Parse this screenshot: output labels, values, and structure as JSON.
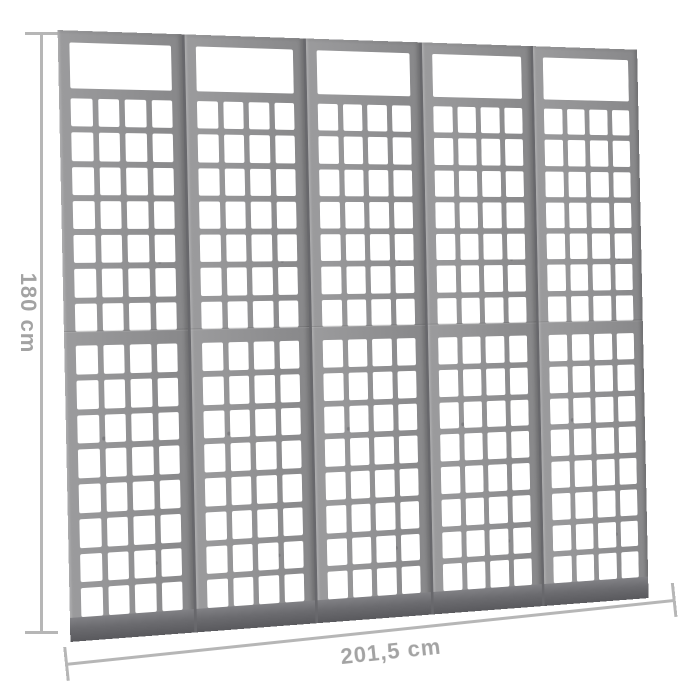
{
  "product": {
    "name": "5-panel wooden trellis room divider",
    "panel_count": 5,
    "panel_sections": [
      "top-window",
      "upper-trellis",
      "lower-trellis"
    ],
    "upper_grid": {
      "rows": 7,
      "cols": 4
    },
    "lower_grid": {
      "rows": 8,
      "cols": 4
    }
  },
  "dimensions": {
    "height_label": "180 cm",
    "width_label": "201,5 cm"
  },
  "colors": {
    "wood": "#909092",
    "wood_dark": "#6b6b6f",
    "seam": "#68686c",
    "dimension_line": "#b6b6b6",
    "dimension_text": "#a3a3a3",
    "background": "#ffffff"
  }
}
